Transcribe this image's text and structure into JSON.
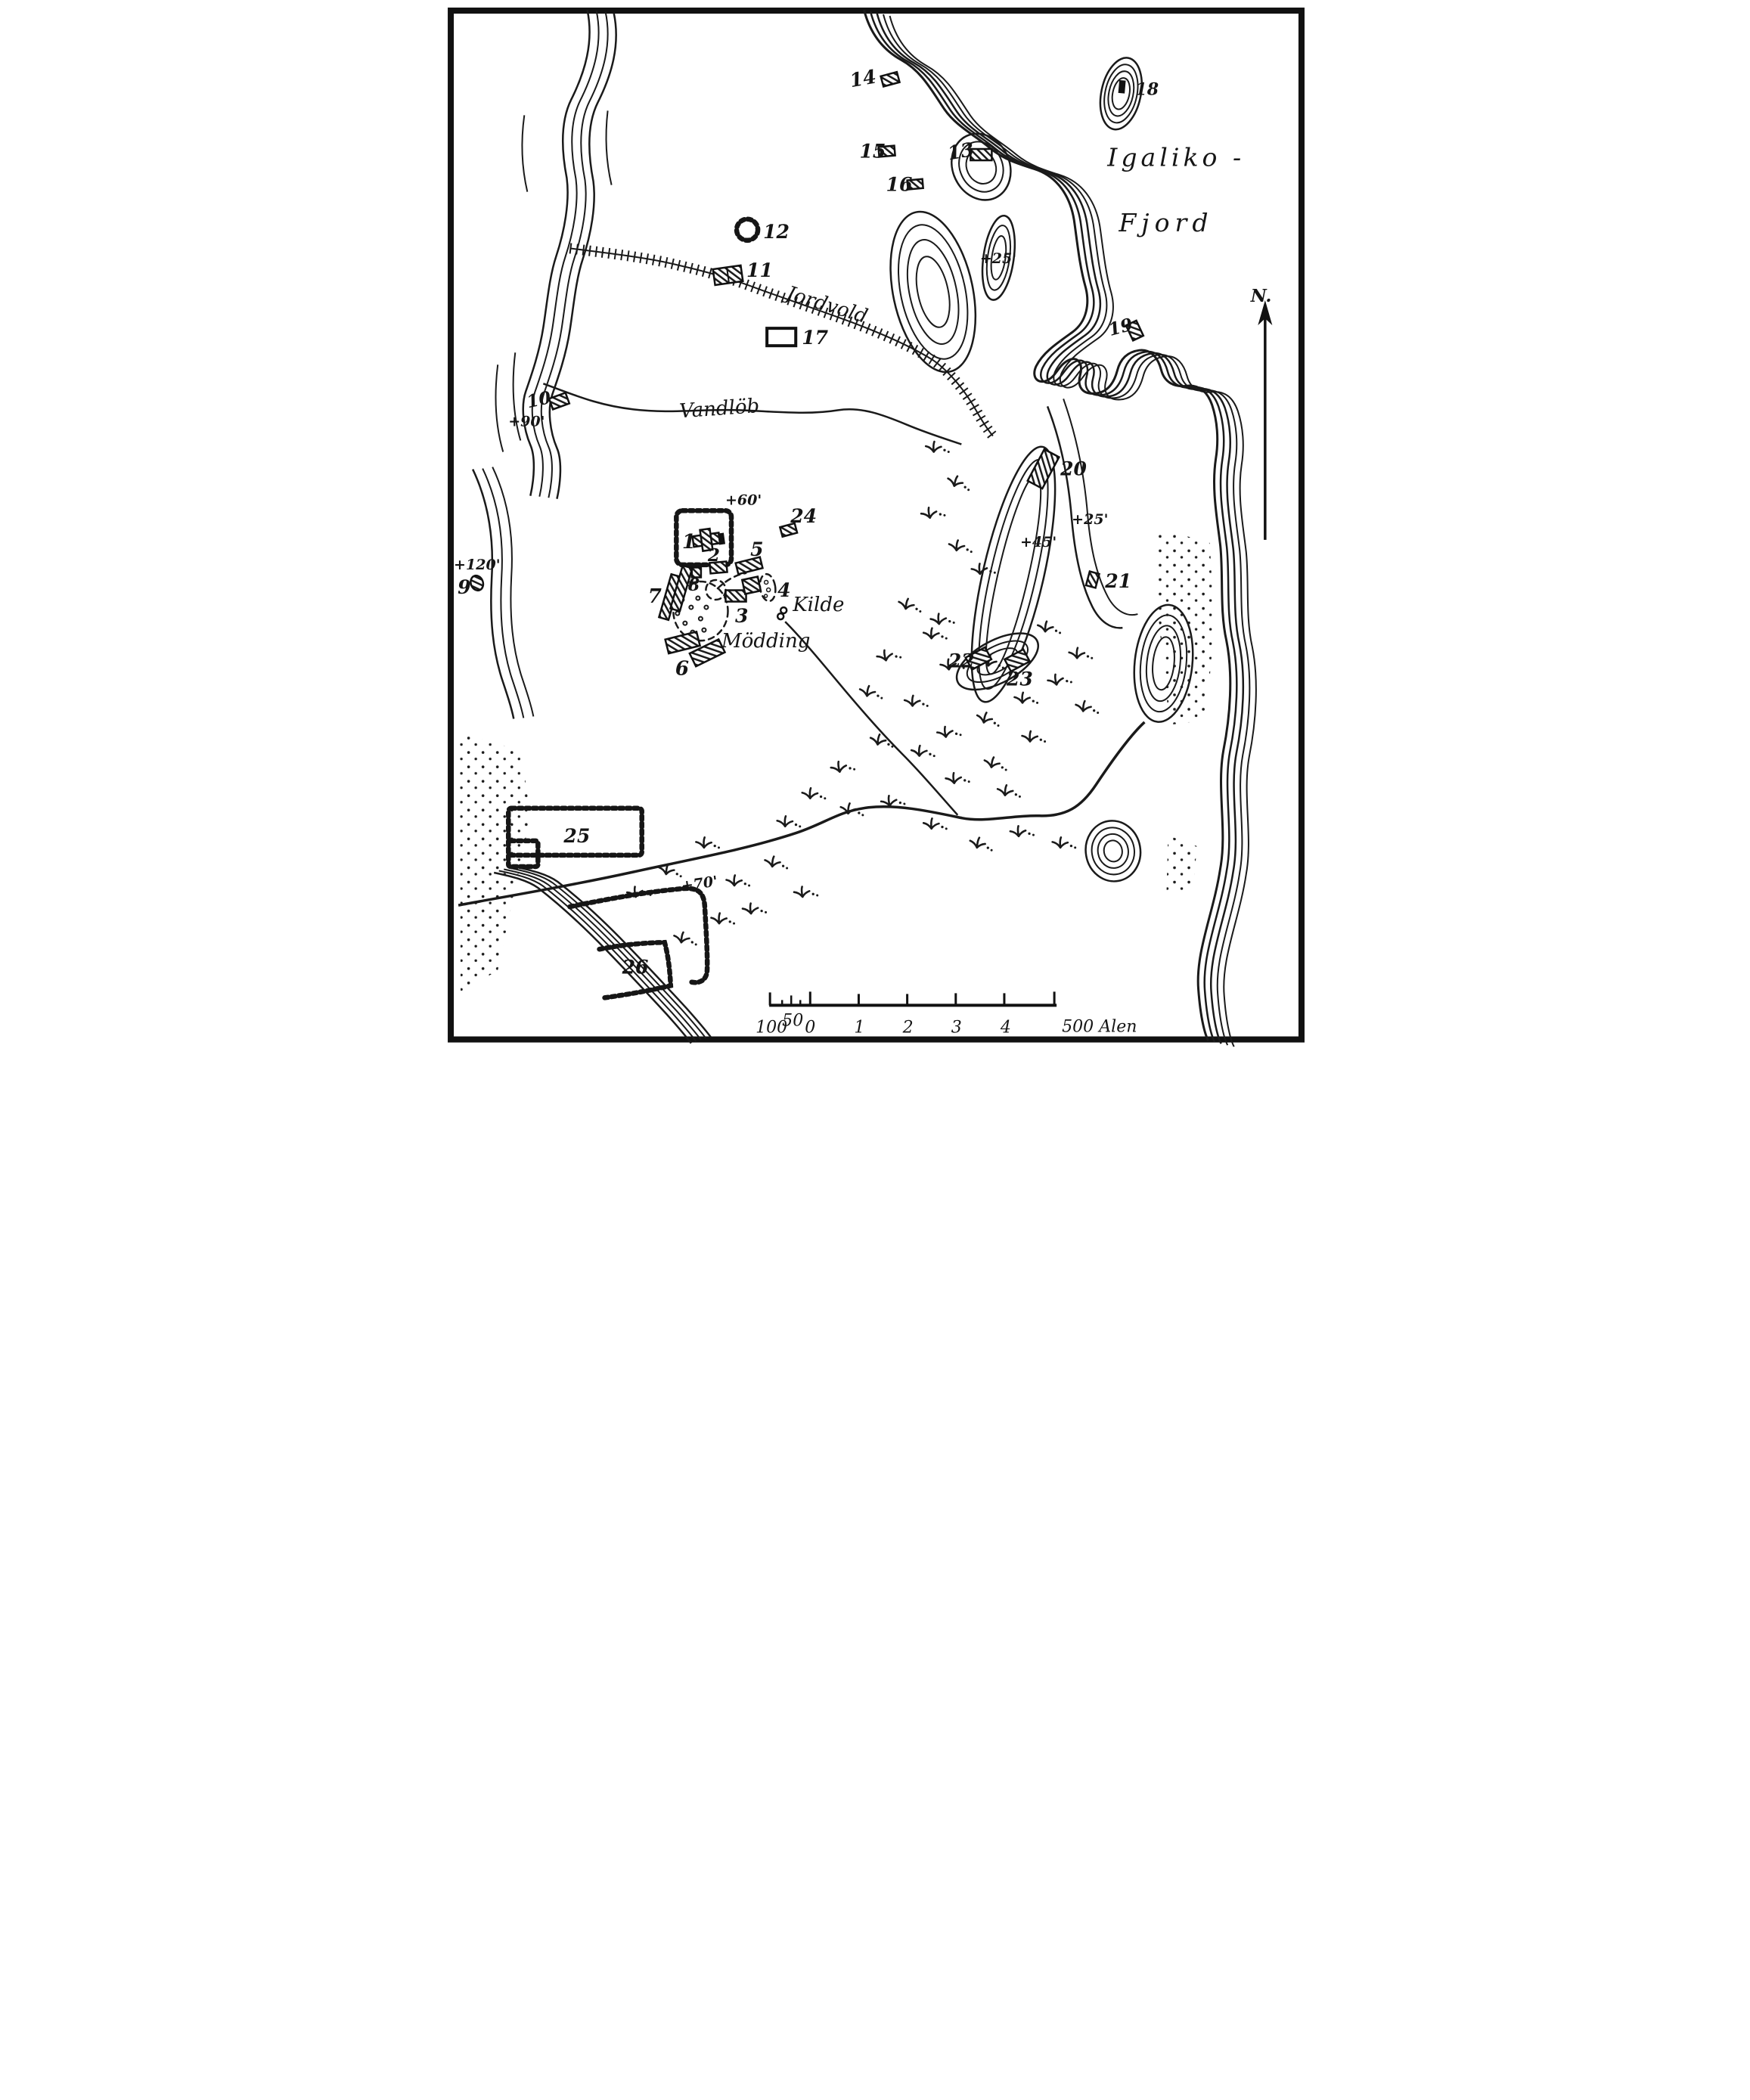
{
  "colors": {
    "ink": "#1a1a1a",
    "paper": "#ffffff"
  },
  "labels": {
    "fjord1": "Igaliko -",
    "fjord2": "Fjord",
    "north": "N.",
    "jordvold": "Jordvold",
    "vandlob": "Vandlöb",
    "kilde": "Kilde",
    "modding": "Mödding"
  },
  "elevations": {
    "e60": "+60'",
    "e90": "+90'",
    "e120": "+120'",
    "e45": "+45'",
    "e25_hill": "+25'",
    "e25_valley": "+25'",
    "e70": "+70'"
  },
  "ruins": {
    "r1": "1",
    "r2": "2",
    "r3": "3",
    "r4": "4",
    "r5": "5",
    "r6": "6",
    "r7": "7",
    "r8": "8",
    "r9": "9",
    "r10": "10",
    "r11": "11",
    "r12": "12",
    "r13": "13",
    "r14": "14",
    "r15": "15",
    "r16": "16",
    "r17": "17",
    "r18": "18",
    "r19": "19",
    "r20": "20",
    "r21": "21",
    "r22": "22",
    "r23": "23",
    "r24": "24",
    "r25": "25",
    "r26": "26"
  },
  "scale_bar": {
    "tick_labels": [
      "100",
      "50",
      "0",
      "1",
      "2",
      "3",
      "4"
    ],
    "end_label": "500 Alen"
  }
}
